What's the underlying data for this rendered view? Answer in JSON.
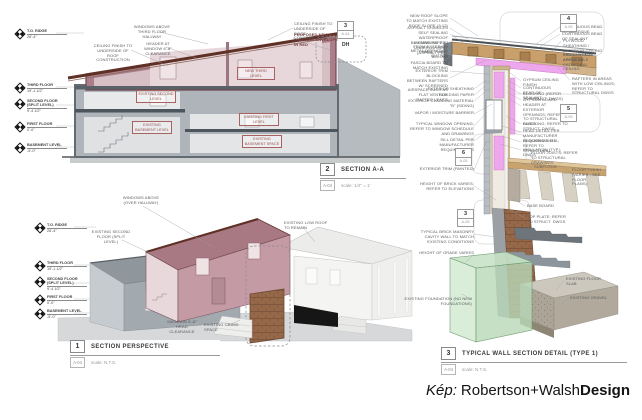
{
  "caption": {
    "prefix": "Kép:",
    "name": "Robertson+Walsh",
    "bold": "Design"
  },
  "colors": {
    "addition_pink": "#c49aa4",
    "wall_gray": "#8f979d",
    "roof_brown": "#5f3026",
    "insulation_magenta": "#eea6ec",
    "wood_tan": "#c9a06b",
    "brick_brown": "#96684a",
    "foundation_green": "#cde9cd",
    "label_red": "#99504d"
  },
  "levels": [
    {
      "label": "T.O. RIDGE",
      "elev": "26'-4\""
    },
    {
      "label": "THIRD FLOOR",
      "elev": "19'-1 1/2\""
    },
    {
      "label": "SECOND FLOOR (SPLIT LEVEL)",
      "elev": "9'-4 1/2\""
    },
    {
      "label": "FIRST FLOOR",
      "elev": "0'-0\""
    },
    {
      "label": "BASEMENT LEVEL",
      "elev": "-5'-0\""
    }
  ],
  "title_blocks": {
    "perspective": {
      "num": "1",
      "title": "SECTION PERSPECTIVE",
      "sheet": "A-04",
      "scale": "scale: N.T.S."
    },
    "section": {
      "num": "2",
      "title": "SECTION A-A",
      "sheet": "A-04",
      "scale": "scale: 1/4\" = 1'"
    },
    "wall": {
      "num": "3",
      "title": "TYPICAL WALL SECTION DETAIL (TYPE 1)",
      "sheet": "A-04",
      "scale": "scale: N.T.S."
    }
  },
  "section_aa": {
    "labels": [
      "WINDOWS ABOVE THIRD FLOOR HALLWAY",
      "CEILING FINISH TO UNDERSIDE OF ROOF CONSTRUCTION",
      "HEADER AT WINDOW 6'-8\" CLEARANCE",
      "CEILING FINISH TO UNDERSIDE OF ROOF CONSTRUCTION",
      "PROPOSED NEW ADDITION ENVELOPE IN RED"
    ],
    "rooms": [
      "NEW THIRD LEVEL",
      "EXISTING SECOND LEVEL",
      "EXISTING FIRST LEVEL",
      "EXISTING BASEMENT LEVEL",
      "EXISTING BASEMENT SPACE"
    ],
    "callout": {
      "num": "3",
      "sheet": "A-04",
      "tag": "DH"
    }
  },
  "perspective": {
    "labels": [
      "WINDOWS ABOVE (OVER HALLWAY)",
      "EXISTING SECOND FLOOR (SPLIT LEVEL)",
      "EXISTING LOW ROOF TO REMAIN",
      "MAINTAIN 6'-8\" HEAD CLEARANCE",
      "EXISTING CRAWL SPACE"
    ]
  },
  "wall_detail": {
    "left_labels": [
      "NEW ROOF SLOPE TO MATCH EXISTING ROOF SLOPE (3:12)",
      "ASPHALT SHINGLES",
      "SELF SEALING WATERPROOF MEMBRANE 2'-0\" FROM EXTERIOR WALL PLANE",
      "BUILDING PAPER / UNDERLAYMENT (ASPHALT FELT BELOW)",
      "METAL DRIP EDGE",
      "GUTTER",
      "FASCIA BOARD TO MATCH EXISTING",
      "EXTERIOR TRIM",
      "BLOCKING BETWEEN RAFTERS W/ SCREENED AIRSPACE SUCH AS FLAT VENT OR RAFTER VENTS",
      "EXTERIOR SHEATHING",
      "BUILDING PAPER",
      "EXTERIOR CLADDING MATERIAL \"B\" (SIDING)",
      "VAPOR / MOISTURE BARRIER",
      "TYPICAL WINDOW OPENING; REFER TO WINDOW SCHEDULE AND DRAWINGS",
      "SILL DETAIL PER MANUFACTURER REQUIREMENTS",
      "EXTERIOR TRIM (PAINTED)",
      "HEIGHT OF BRICK VARIES; REFER TO ELEVATIONS",
      "TYPICAL BRICK MASONRY CAVITY WALL TO MATCH EXISTING CONDITIONS",
      "HEIGHT OF GRADE VARIES",
      "EXISTING FOUNDATION (NO NEW FOUNDATIONS)"
    ],
    "right_labels": [
      "CONTINUOUS BEAD OF ADHESIVE",
      "CONTINUOUS BEAD OF SEALANT",
      "PLYWOOD SHEATHING / EXTERIOR CEILING FINISH WHERE APPLICABLE",
      "INSULATION IN AREAS W/ CATHEDRAL CEILING",
      "RAFTERS IN AREAS WITH LOW CEILINGS; REFER TO STRUCTURAL DWGS",
      "GYPSUM CEILING FINISH",
      "CONTINUOUS BEAD OF SEALANT",
      "BLOCKING (REFER TO STRUCT. DWGS)",
      "GYPSUM BOARD",
      "HEADER AT EXTERIOR OPENINGS; REFER TO STRUCTURAL DWGS",
      "BLOCKING; REFER TO STRUCT. DWGS",
      "HEAD DETAIL PER MANUFACTURER REQUIREMENTS",
      "BLOCKING & SILL; REFER TO STRUCTURAL DWGS",
      "INSULATION (TYP.)",
      "FLOOR JOISTS; REFER TO STRUCTURAL DRAWINGS",
      "SUBFLOOR",
      "FLOOR FINISH (VARIES - SEE FLOOR PLANS)",
      "BASE BOARD",
      "TOP PLATE; REFER TO STRUCT. DWGS",
      "EXISTING FLOOR SLAB",
      "EXISTING GRAVEL"
    ],
    "callouts": [
      {
        "num": "4",
        "sheet": "A-05"
      },
      {
        "num": "5",
        "sheet": "A-05"
      },
      {
        "num": "6",
        "sheet": "A-05"
      },
      {
        "num": "3",
        "sheet": "A-05"
      }
    ]
  }
}
